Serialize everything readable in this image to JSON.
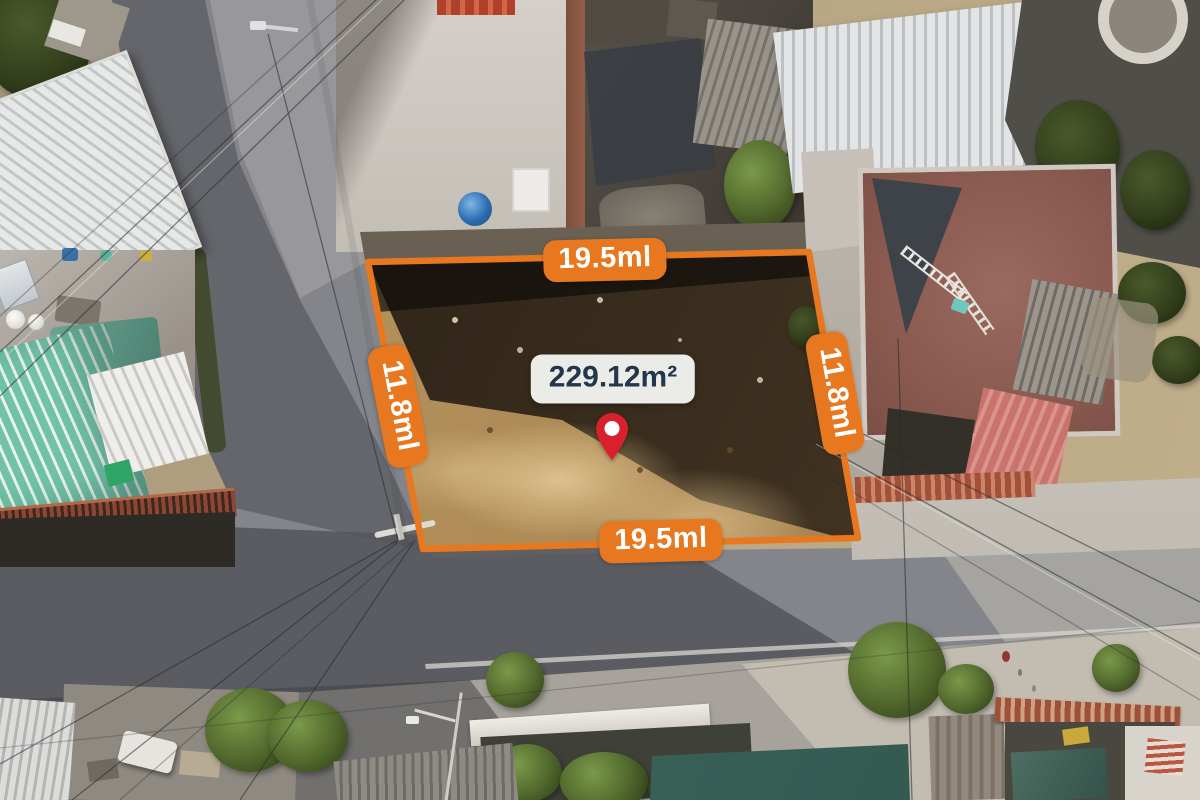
{
  "overlay": {
    "measurements": {
      "top": "19.5ml",
      "bottom": "19.5ml",
      "left": "11.8ml",
      "right": "11.8ml"
    },
    "area_label": {
      "text": "229.12m²",
      "background": "#F3F4F0",
      "text_color": "#24374A"
    },
    "badge_style": {
      "background": "#E8781F",
      "text_color": "#FFFFFF"
    },
    "boundary_color": "#E8781F",
    "pin": {
      "icon": "location-pin",
      "color": "#D7222E"
    }
  }
}
